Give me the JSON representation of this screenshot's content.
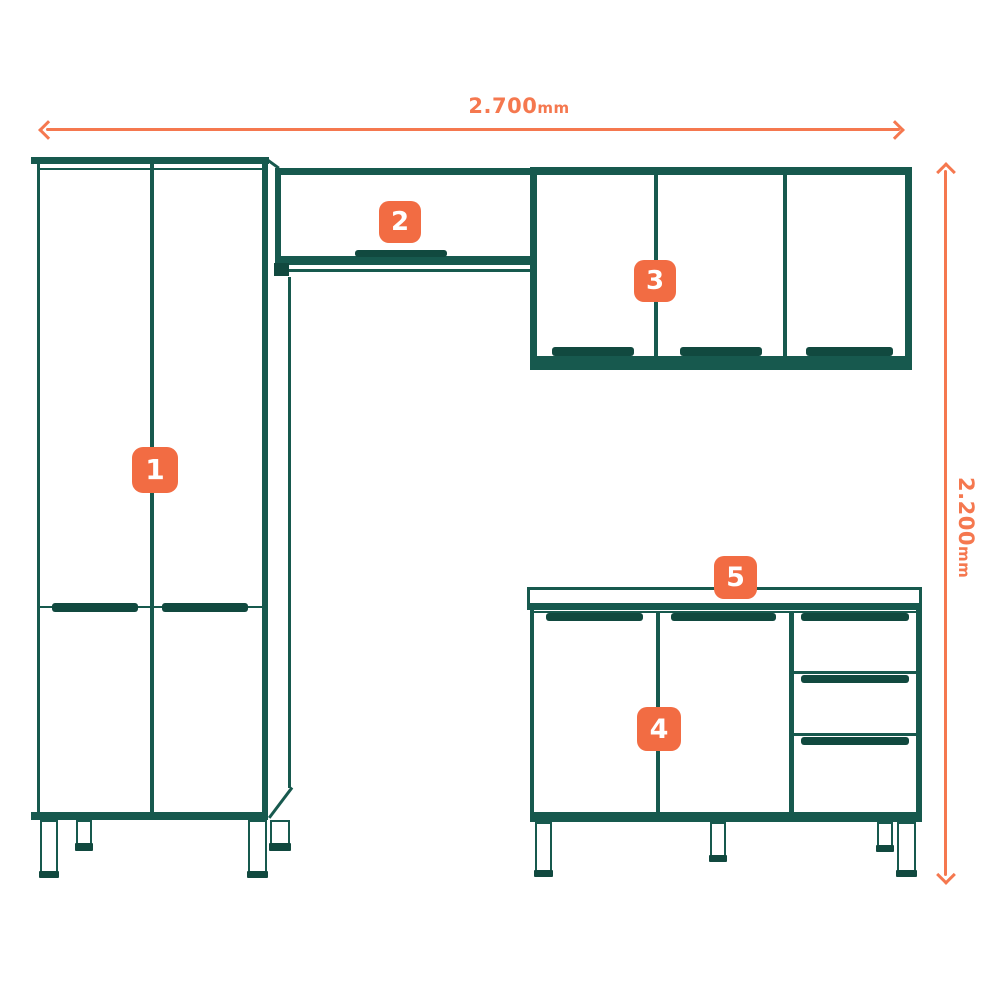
{
  "diagram": {
    "badges": [
      {
        "label": "1"
      },
      {
        "label": "2"
      },
      {
        "label": "3"
      },
      {
        "label": "4"
      },
      {
        "label": "5"
      }
    ],
    "dimensions": {
      "width": {
        "value": "2.700",
        "unit": "mm"
      },
      "height": {
        "value": "2.200",
        "unit": "mm"
      }
    },
    "colors": {
      "line": "#17594e",
      "accent": "#f5784f",
      "badge": "#f26c43",
      "badge_text": "#ffffff"
    }
  }
}
